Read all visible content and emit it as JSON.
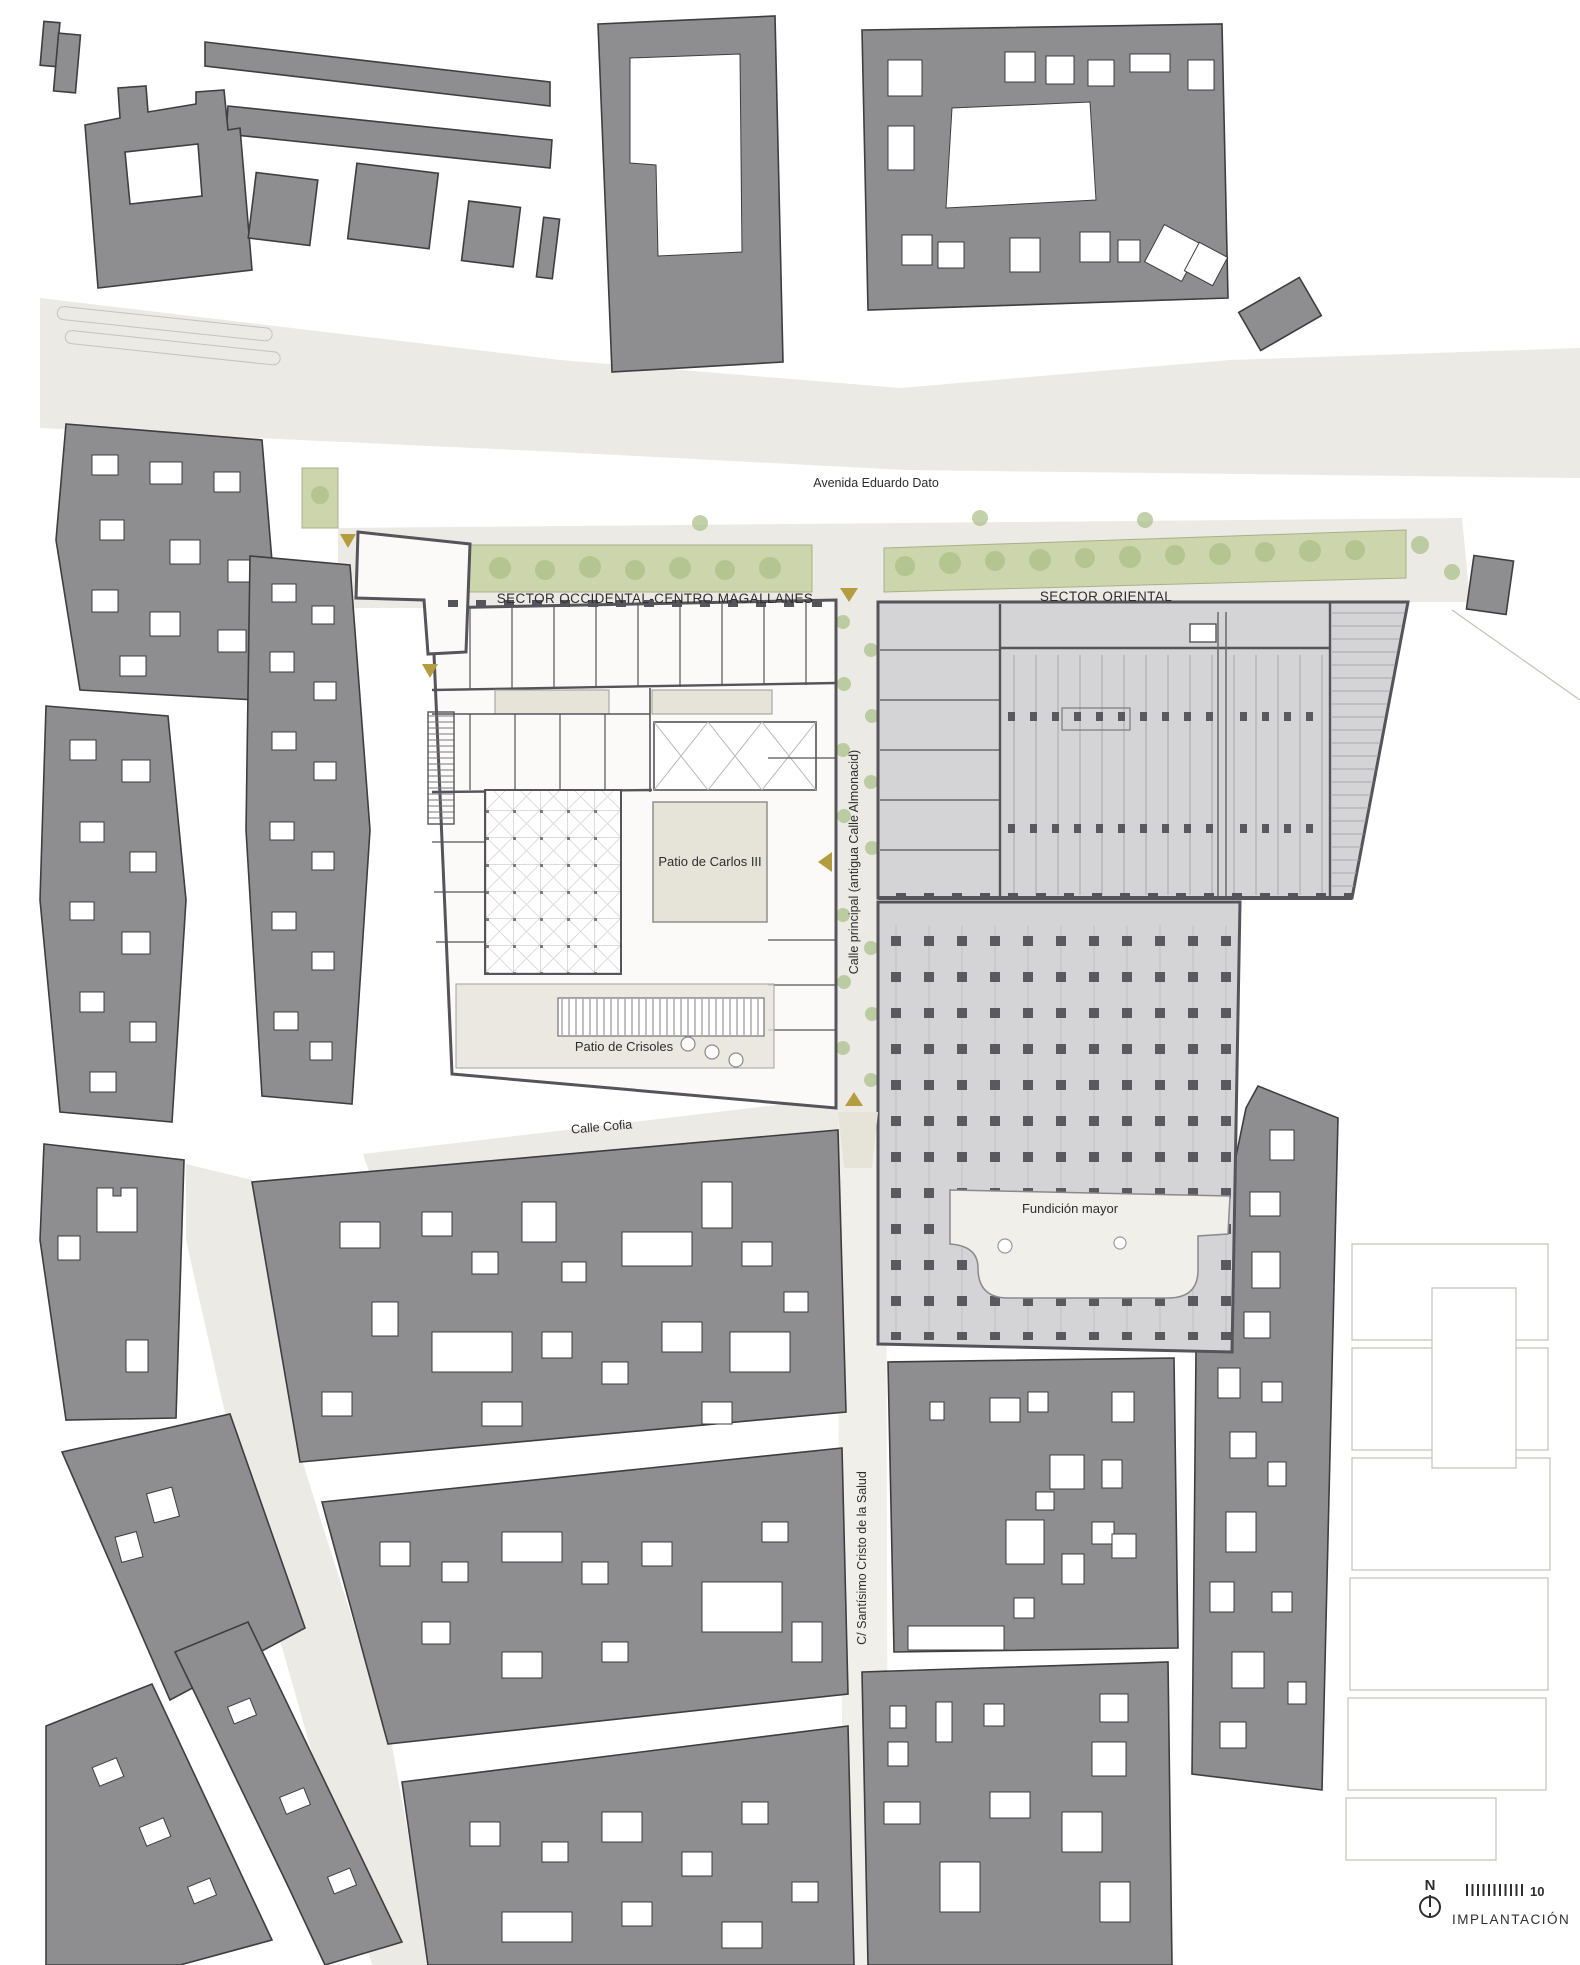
{
  "labels": {
    "avenida": "Avenida Eduardo Dato",
    "sector_occidental": "SECTOR OCCIDENTAL-CENTRO MAGALLANES",
    "sector_oriental": "SECTOR ORIENTAL",
    "calle_principal": "Calle principal (antigua Calle Almonacid)",
    "patio_carlos": "Patio de Carlos III",
    "patio_crisoles": "Patio de Crisoles",
    "calle_cofia": "Calle Cofia",
    "fundicion": "Fundición mayor",
    "calle_santisimo": "C/ Santísimo Cristo de la Salud"
  },
  "legend": {
    "north_label": "N",
    "scale_value": "10",
    "drawing_title": "IMPLANTACIÓN"
  },
  "colors": {
    "block_gray": "#8e8e90",
    "outline": "#3e3e40",
    "street_beige": "#eceae5",
    "courtyard_beige": "#e6e3d9",
    "green_strip": "#ccd5ab",
    "tree_green": "#a9bd87",
    "gold": "#b39d3f",
    "complex_east_fill": "#d4d4d6",
    "complex_west_fill": "#fbfaf8",
    "complex_wall": "#54545a",
    "fundicion_fill": "#f0efea",
    "text_color": "#2e2e2e"
  }
}
